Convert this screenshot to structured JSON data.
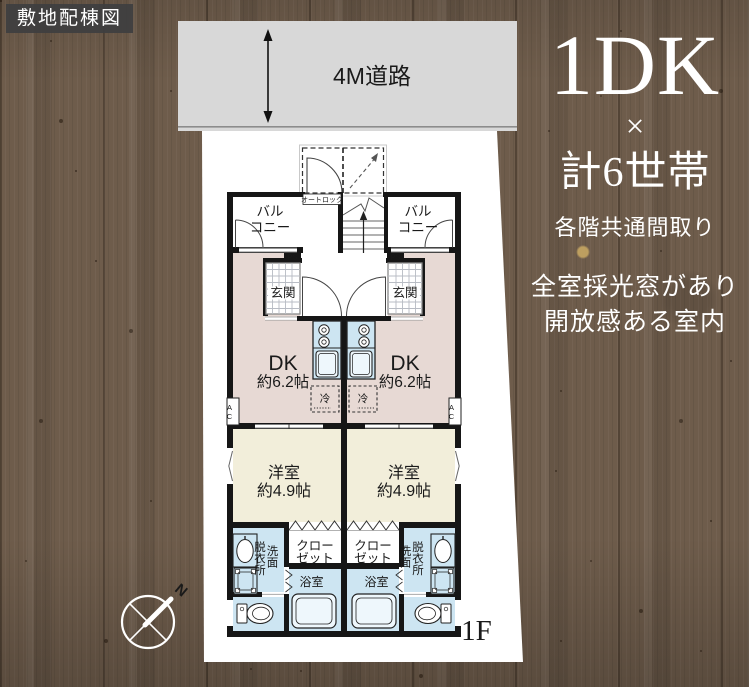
{
  "badge": {
    "label": "敷地配棟図"
  },
  "road": {
    "label": "4M道路"
  },
  "promo": {
    "title": "1DK",
    "multiply": "×",
    "households": "計6世帯",
    "subtitle": "各階共通間取り",
    "desc_line1": "全室採光窓があり",
    "desc_line2": "開放感ある室内"
  },
  "plan": {
    "balcony_line1": "バル",
    "balcony_line2": "コニー",
    "entrance": "玄関",
    "autolock": "オートロック",
    "ps": "PS",
    "dk_label": "DK",
    "dk_size": "約6.2帖",
    "fridge": "冷",
    "ac": "AC",
    "western_label": "洋室",
    "western_size": "約4.9帖",
    "closet_line1": "クロー",
    "closet_line2": "ゼット",
    "dressing_room": "脱衣所",
    "washroom": "洗面",
    "bath": "浴室",
    "floor_label": "1F"
  },
  "compass": {
    "north": "N"
  },
  "colors": {
    "wood": "#6e5c4b",
    "road_fill": "#d8d8d8",
    "site_fill": "#ffffff",
    "wall": "#161616",
    "dk_floor": "#e7d9d4",
    "room_floor": "#f2eeda",
    "wet_floor": "#cde5f2",
    "promo_text": "#ffffff"
  }
}
